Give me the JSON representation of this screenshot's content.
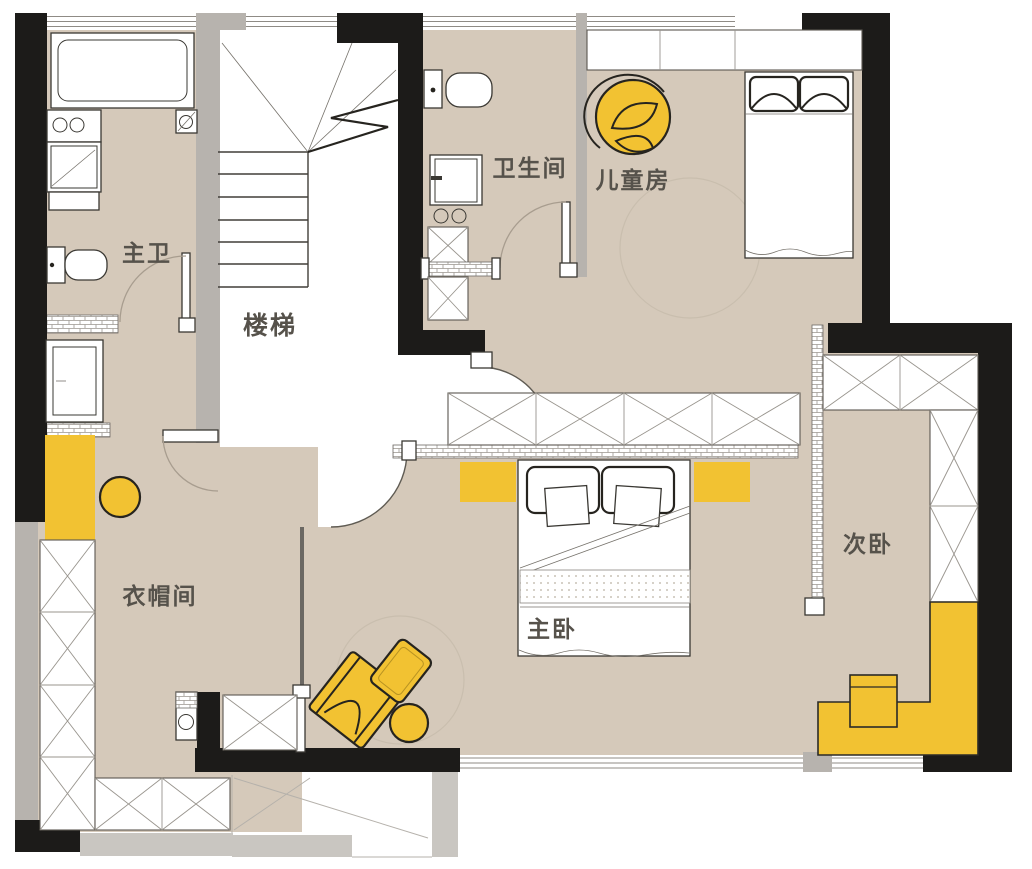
{
  "plan": {
    "rooms": {
      "master_bath": {
        "label": "主卫"
      },
      "stairs": {
        "label": "楼梯"
      },
      "bathroom": {
        "label": "卫生间"
      },
      "kids_room": {
        "label": "儿童房"
      },
      "master_bedroom": {
        "label": "主卧"
      },
      "secondary_bedroom": {
        "label": "次卧"
      },
      "cloakroom": {
        "label": "衣帽间"
      }
    }
  },
  "colors": {
    "paper": "#ffffff",
    "floor": "#d5c9ba",
    "wall": "#1c1b19",
    "wall_gray": "#b7b3ae",
    "wall_gray_light": "#c9c6c1",
    "accent": "#f2c232",
    "outline": "#3a3833",
    "outline_bold": "#26241f",
    "label": "#56524b",
    "arc": "#a89d8f",
    "arc_dark": "#5f5b53",
    "window_line": "#8f8b85",
    "hatch_line": "#9a958e",
    "faint": "#c9beae"
  }
}
